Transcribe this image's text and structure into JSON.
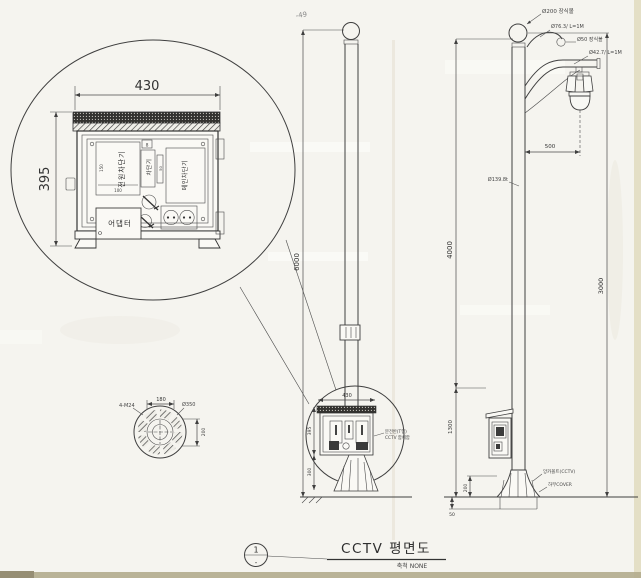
{
  "page": {
    "corner_mark": "-49"
  },
  "cabinet_detail": {
    "dim_width": "430",
    "dim_height": "395",
    "breaker_left": "전원차단기",
    "breaker_mid": "차단기",
    "breaker_mid_top": "8",
    "breaker_right": "메인차단기",
    "adapter": "어댑터",
    "sub_left_side": "150",
    "sub_left_bottom": "100",
    "sub_mid_side": "50"
  },
  "middle_pole": {
    "height_dim": "6000",
    "balloon": {
      "dim_width": "430",
      "dim_height": "395",
      "dim_lower": "300",
      "callout_line1": "분전반(T형)",
      "callout_line2": "CCTV 함체함"
    }
  },
  "right_pole": {
    "finial_label": "Ø200 장식볼",
    "hook_label": "Ø76.3/ L=1M",
    "scroll_label": "Ø50 장식볼",
    "arm_label": "Ø42.7/ L=1M",
    "offset_dim": "500",
    "pole_label": "Ø139.8t",
    "dim_left_upper": "4000",
    "dim_left_lower": "1300",
    "dim_right": "3000",
    "anchor_label": "앙카볼트(CCTV)",
    "cover_label": "하부COVER",
    "base_dim": "200",
    "embed_dim": "50"
  },
  "anchor_plan": {
    "dim_top": "180",
    "bolt_label": "4-M24",
    "dia_label": "Ø350",
    "dim_right": "200"
  },
  "title_block": {
    "ref_no": "1",
    "ref_sub": "-",
    "title": "CCTV 평면도",
    "scale": "축척 NONE"
  }
}
